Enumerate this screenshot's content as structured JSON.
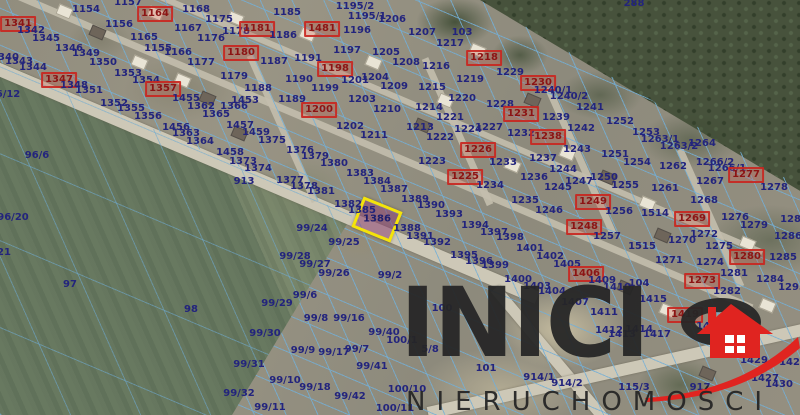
{
  "map": {
    "highlighted_parcel": "1386",
    "labels": [
      [
        "1157",
        128,
        3
      ],
      [
        "1154",
        86,
        10
      ],
      [
        "1164",
        155,
        14,
        1
      ],
      [
        "1168",
        196,
        10
      ],
      [
        "1175",
        219,
        20
      ],
      [
        "1178",
        236,
        32
      ],
      [
        "1181",
        257,
        29,
        1
      ],
      [
        "1156",
        119,
        25
      ],
      [
        "1167",
        188,
        29
      ],
      [
        "1341",
        18,
        24,
        1
      ],
      [
        "1342",
        31,
        31
      ],
      [
        "1345",
        46,
        39
      ],
      [
        "1165",
        144,
        38
      ],
      [
        "1176",
        211,
        39
      ],
      [
        "1155",
        158,
        49
      ],
      [
        "1166",
        178,
        53
      ],
      [
        "1180",
        241,
        53,
        1
      ],
      [
        "1346",
        69,
        49
      ],
      [
        "1349",
        86,
        54
      ],
      [
        "1340",
        5,
        58
      ],
      [
        "1343",
        19,
        62
      ],
      [
        "1344",
        33,
        68
      ],
      [
        "1350",
        103,
        63
      ],
      [
        "1177",
        201,
        63
      ],
      [
        "6/12",
        8,
        95
      ],
      [
        "1353",
        128,
        74
      ],
      [
        "1354",
        146,
        81
      ],
      [
        "1347",
        59,
        80,
        1
      ],
      [
        "1348",
        74,
        86
      ],
      [
        "1351",
        89,
        91
      ],
      [
        "1357",
        163,
        89,
        1
      ],
      [
        "1455",
        186,
        99
      ],
      [
        "1179",
        234,
        77
      ],
      [
        "1188",
        258,
        89
      ],
      [
        "1352",
        114,
        104
      ],
      [
        "1355",
        131,
        109
      ],
      [
        "1362",
        201,
        107
      ],
      [
        "1366",
        234,
        107
      ],
      [
        "1453",
        245,
        101
      ],
      [
        "1365",
        216,
        115
      ],
      [
        "1356",
        148,
        117
      ],
      [
        "1456",
        176,
        128
      ],
      [
        "1457",
        240,
        126
      ],
      [
        "1363",
        186,
        134
      ],
      [
        "1364",
        200,
        142
      ],
      [
        "1459",
        256,
        133
      ],
      [
        "1375",
        272,
        141
      ],
      [
        "1458",
        230,
        153
      ],
      [
        "1373",
        243,
        162
      ],
      [
        "1374",
        258,
        169
      ],
      [
        "96/6",
        37,
        156
      ],
      [
        "913",
        244,
        182
      ],
      [
        "96/20",
        13,
        218
      ],
      [
        "21",
        4,
        253
      ],
      [
        "97",
        70,
        285
      ],
      [
        "98",
        191,
        310
      ],
      [
        "1185",
        287,
        13
      ],
      [
        "1186",
        283,
        36
      ],
      [
        "1195/2",
        355,
        7
      ],
      [
        "1195/1",
        367,
        17
      ],
      [
        "1206",
        392,
        20
      ],
      [
        "1481",
        322,
        29,
        1
      ],
      [
        "1196",
        357,
        31
      ],
      [
        "1207",
        422,
        33
      ],
      [
        "103",
        462,
        33
      ],
      [
        "1197",
        347,
        51
      ],
      [
        "1217",
        450,
        44
      ],
      [
        "1205",
        386,
        53
      ],
      [
        "1208",
        406,
        63
      ],
      [
        "1218",
        484,
        58,
        1
      ],
      [
        "1187",
        274,
        62
      ],
      [
        "1191",
        308,
        59
      ],
      [
        "1198",
        335,
        69,
        1
      ],
      [
        "1216",
        436,
        67
      ],
      [
        "1229",
        510,
        73
      ],
      [
        "1230",
        538,
        83,
        1
      ],
      [
        "1190",
        299,
        80
      ],
      [
        "1204",
        375,
        78
      ],
      [
        "1201",
        355,
        81
      ],
      [
        "1219",
        470,
        80
      ],
      [
        "1199",
        325,
        89
      ],
      [
        "1209",
        394,
        87
      ],
      [
        "1215",
        432,
        88
      ],
      [
        "1189",
        292,
        100
      ],
      [
        "1203",
        362,
        100
      ],
      [
        "1220",
        462,
        99
      ],
      [
        "1228",
        500,
        105
      ],
      [
        "1200",
        319,
        110,
        1
      ],
      [
        "1210",
        387,
        110
      ],
      [
        "1214",
        429,
        108
      ],
      [
        "1231",
        521,
        114,
        1
      ],
      [
        "1221",
        450,
        118
      ],
      [
        "1202",
        350,
        127
      ],
      [
        "1213",
        420,
        128
      ],
      [
        "1224",
        468,
        130
      ],
      [
        "1227",
        489,
        128
      ],
      [
        "1211",
        374,
        136
      ],
      [
        "1222",
        440,
        138
      ],
      [
        "1232",
        521,
        134
      ],
      [
        "1238",
        548,
        137,
        1
      ],
      [
        "288",
        634,
        4
      ],
      [
        "1240/1",
        553,
        91
      ],
      [
        "1240/2",
        569,
        97
      ],
      [
        "1241",
        590,
        108
      ],
      [
        "1239",
        556,
        118
      ],
      [
        "1252",
        620,
        122
      ],
      [
        "1242",
        581,
        129
      ],
      [
        "1253",
        646,
        133
      ],
      [
        "1243",
        577,
        150
      ],
      [
        "1251",
        615,
        155
      ],
      [
        "1254",
        637,
        163
      ],
      [
        "1263/1",
        660,
        140
      ],
      [
        "1263/2",
        679,
        147
      ],
      [
        "1264",
        702,
        144
      ],
      [
        "1262",
        673,
        167
      ],
      [
        "1266/2",
        715,
        163
      ],
      [
        "1266/1",
        727,
        169
      ],
      [
        "1277",
        746,
        175,
        1
      ],
      [
        "1278",
        774,
        188
      ],
      [
        "1237",
        543,
        159
      ],
      [
        "1244",
        563,
        170
      ],
      [
        "1247",
        579,
        182
      ],
      [
        "1250",
        604,
        178
      ],
      [
        "1255",
        625,
        186
      ],
      [
        "1267",
        710,
        182
      ],
      [
        "1245",
        558,
        188
      ],
      [
        "1261",
        665,
        189
      ],
      [
        "1249",
        593,
        202,
        1
      ],
      [
        "1268",
        704,
        201
      ],
      [
        "1246",
        549,
        211
      ],
      [
        "1256",
        619,
        212
      ],
      [
        "1514",
        655,
        214
      ],
      [
        "1269",
        692,
        219,
        1
      ],
      [
        "1276",
        735,
        218
      ],
      [
        "1279",
        754,
        226
      ],
      [
        "1248",
        584,
        227,
        1
      ],
      [
        "1287",
        794,
        220
      ],
      [
        "1286",
        788,
        237
      ],
      [
        "1257",
        607,
        237
      ],
      [
        "1272",
        704,
        235
      ],
      [
        "1515",
        642,
        247
      ],
      [
        "1270",
        682,
        241
      ],
      [
        "1275",
        719,
        247
      ],
      [
        "1280",
        747,
        257,
        1
      ],
      [
        "1285",
        783,
        258
      ],
      [
        "1402",
        550,
        257
      ],
      [
        "1405",
        567,
        265
      ],
      [
        "1271",
        669,
        261
      ],
      [
        "1274",
        710,
        263
      ],
      [
        "1226",
        478,
        150,
        1
      ],
      [
        "1223",
        432,
        162
      ],
      [
        "1233",
        503,
        163
      ],
      [
        "1225",
        465,
        177,
        1
      ],
      [
        "1234",
        490,
        186
      ],
      [
        "1236",
        534,
        178
      ],
      [
        "1235",
        525,
        201
      ],
      [
        "1376",
        300,
        151
      ],
      [
        "1379",
        315,
        157
      ],
      [
        "1380",
        334,
        164
      ],
      [
        "1383",
        360,
        174
      ],
      [
        "1384",
        377,
        182
      ],
      [
        "1387",
        394,
        190
      ],
      [
        "1377",
        290,
        181
      ],
      [
        "1378",
        304,
        187
      ],
      [
        "1381",
        321,
        192
      ],
      [
        "1389",
        415,
        200
      ],
      [
        "1390",
        431,
        206
      ],
      [
        "1382",
        348,
        205
      ],
      [
        "1385",
        362,
        211
      ],
      [
        "1393",
        449,
        215
      ],
      [
        "1388",
        407,
        229
      ],
      [
        "1394",
        475,
        226
      ],
      [
        "1397",
        494,
        233
      ],
      [
        "99/24",
        312,
        229
      ],
      [
        "1391",
        420,
        237
      ],
      [
        "1398",
        510,
        238
      ],
      [
        "99/25",
        344,
        243
      ],
      [
        "1392",
        437,
        243
      ],
      [
        "1401",
        530,
        249
      ],
      [
        "99/28",
        295,
        257
      ],
      [
        "1395",
        464,
        256
      ],
      [
        "1396",
        479,
        262
      ],
      [
        "99/27",
        315,
        265
      ],
      [
        "1399",
        495,
        266
      ],
      [
        "99/26",
        334,
        274
      ],
      [
        "99/2",
        390,
        276
      ],
      [
        "1400",
        518,
        280
      ],
      [
        "1403",
        537,
        287
      ],
      [
        "1404",
        552,
        292
      ],
      [
        "1406",
        586,
        274,
        1
      ],
      [
        "1409",
        602,
        281
      ],
      [
        "1410",
        617,
        288
      ],
      [
        "104",
        639,
        284
      ],
      [
        "1281",
        734,
        274
      ],
      [
        "1273",
        702,
        281,
        1
      ],
      [
        "1284",
        770,
        280
      ],
      [
        "1282",
        727,
        292
      ],
      [
        "1293",
        792,
        288
      ],
      [
        "1407",
        575,
        303
      ],
      [
        "1411",
        604,
        313
      ],
      [
        "1415",
        653,
        300
      ],
      [
        "1419",
        685,
        315,
        1
      ],
      [
        "1421",
        710,
        327
      ],
      [
        "1412",
        609,
        331
      ],
      [
        "1413",
        622,
        335
      ],
      [
        "1414",
        639,
        330
      ],
      [
        "1417",
        657,
        335
      ],
      [
        "115/3",
        634,
        388
      ],
      [
        "917",
        700,
        388
      ],
      [
        "1427",
        765,
        379
      ],
      [
        "1430",
        779,
        385
      ],
      [
        "1429",
        754,
        361
      ],
      [
        "1428",
        793,
        363
      ],
      [
        "914/1",
        539,
        378
      ],
      [
        "914/2",
        567,
        384
      ],
      [
        "101",
        486,
        369
      ],
      [
        "100",
        442,
        309
      ],
      [
        "99/6",
        305,
        296
      ],
      [
        "99/29",
        277,
        304
      ],
      [
        "99/8",
        316,
        319
      ],
      [
        "99/16",
        349,
        319
      ],
      [
        "99/30",
        265,
        334
      ],
      [
        "99/40",
        384,
        333
      ],
      [
        "100/1",
        402,
        341
      ],
      [
        "99/9",
        303,
        351
      ],
      [
        "99/17",
        334,
        353
      ],
      [
        "99/7",
        357,
        350
      ],
      [
        "5/8",
        430,
        350
      ],
      [
        "99/31",
        249,
        365
      ],
      [
        "99/41",
        372,
        367
      ],
      [
        "99/10",
        285,
        381
      ],
      [
        "99/18",
        315,
        388
      ],
      [
        "99/32",
        239,
        394
      ],
      [
        "99/42",
        350,
        397
      ],
      [
        "99/11",
        270,
        408
      ],
      [
        "100/10",
        407,
        390
      ],
      [
        "100/11",
        395,
        409
      ]
    ]
  },
  "logo": {
    "name": "INICIO",
    "text_before_o": "INICI",
    "subtitle": "NIERUCHOMOŚCI"
  },
  "colors": {
    "parcel_number": "#23247d",
    "sold_marker": "#c92620",
    "cadastral_line": "#73afd7",
    "highlight_border": "#f4e40a",
    "highlight_fill": "#8c4273",
    "logo_text": "#262626",
    "logo_accent": "#e02420"
  }
}
